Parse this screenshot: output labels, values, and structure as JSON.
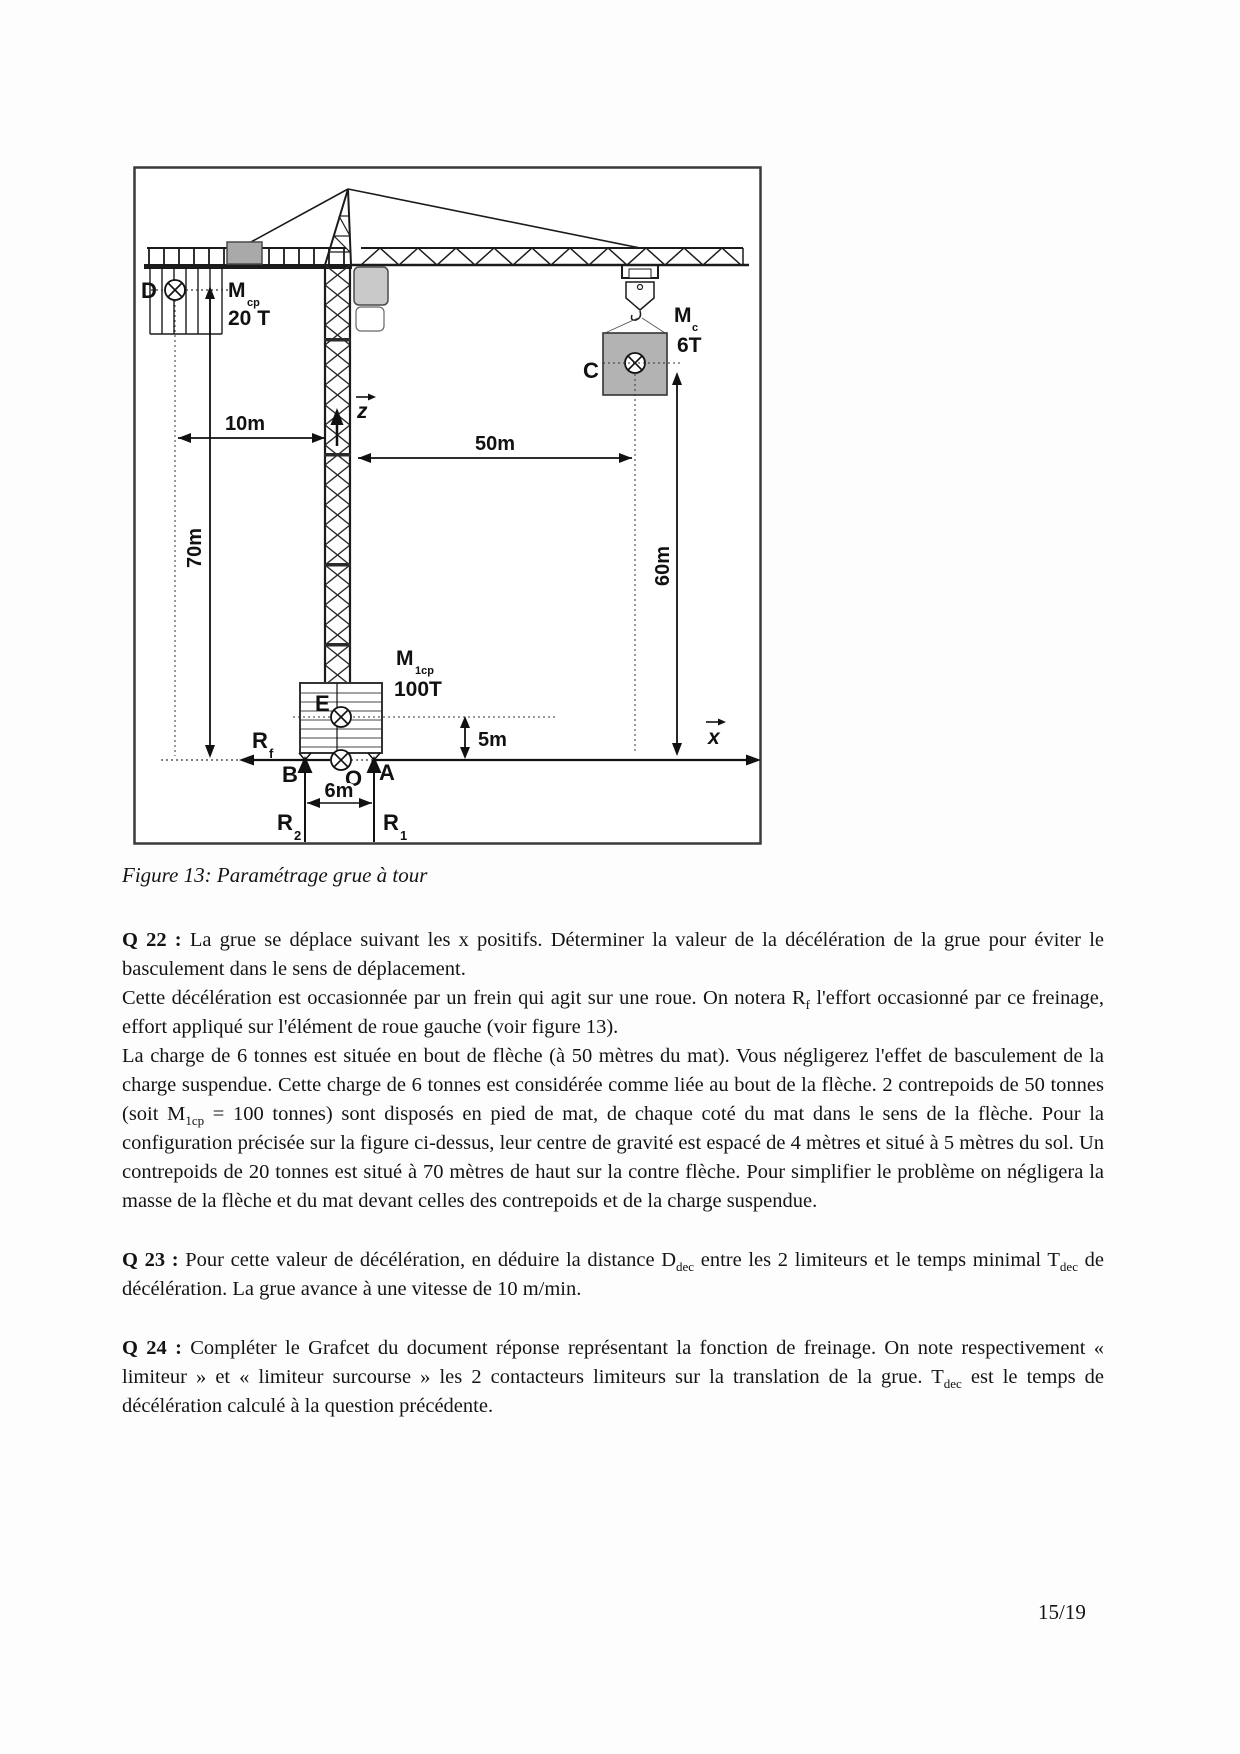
{
  "page": {
    "number": "15/19"
  },
  "figure": {
    "caption": "Figure 13: Paramétrage grue à tour",
    "points": {
      "D": "D",
      "C": "C",
      "E": "E",
      "B": "B",
      "A": "A",
      "O": "O"
    },
    "masses": {
      "mcp": {
        "base": "M",
        "sub": "cp",
        "value": "20 T"
      },
      "mc": {
        "base": "M",
        "sub": "c",
        "value": "6T"
      },
      "m1cp": {
        "base": "M",
        "sub": "1cp",
        "value": "100T"
      }
    },
    "dims": {
      "d10": "10m",
      "d50": "50m",
      "d70": "70m",
      "d60": "60m",
      "d5": "5m",
      "d6": "6m"
    },
    "axes": {
      "z": "z",
      "x": "x"
    },
    "forces": {
      "rf": {
        "base": "R",
        "sub": "f"
      },
      "r1": {
        "base": "R",
        "sub": "1"
      },
      "r2": {
        "base": "R",
        "sub": "2"
      }
    }
  },
  "questions": {
    "q22": {
      "label": "Q 22 :",
      "p1": " La grue se déplace suivant les x positifs. Déterminer la valeur de la décélération de la grue pour éviter le basculement dans le sens de déplacement.",
      "p2a": "Cette décélération est occasionnée par un frein qui agit sur une roue. On notera R",
      "p2sub": "f",
      "p2b": " l'effort occasionné par ce freinage, effort appliqué sur l'élément de roue gauche (voir figure 13).",
      "p3a": "La charge de 6 tonnes est située en bout de flèche (à 50 mètres du mat). Vous négligerez l'effet de basculement de la charge suspendue. Cette charge de 6 tonnes est considérée comme liée au bout de la flèche. 2 contrepoids de 50 tonnes (soit M",
      "p3sub": "1cp",
      "p3b": " = 100 tonnes) sont disposés en pied de mat, de chaque coté du mat dans le sens de la flèche. Pour la configuration précisée sur la figure ci-dessus, leur centre de gravité est espacé de 4 mètres et situé à 5 mètres du sol. Un contrepoids de 20 tonnes est situé à 70 mètres de haut sur la contre flèche. Pour simplifier le problème on négligera la masse de la flèche et du mat devant celles des contrepoids et de la charge suspendue."
    },
    "q23": {
      "label": "Q 23 :",
      "p1a": " Pour cette valeur de décélération, en déduire la distance D",
      "p1sub": "dec",
      "p1b": " entre les 2 limiteurs et le temps minimal T",
      "p1sub2": "dec",
      "p1c": " de décélération.  La grue avance à une vitesse de 10 m/min."
    },
    "q24": {
      "label": "Q 24 :",
      "p1a": " Compléter le Grafcet du document réponse représentant la fonction de freinage. On note respectivement « limiteur » et « limiteur surcourse » les 2 contacteurs limiteurs sur la translation de la grue. T",
      "p1sub": "dec",
      "p1b": " est le temps de décélération calculé à la question précédente."
    }
  }
}
